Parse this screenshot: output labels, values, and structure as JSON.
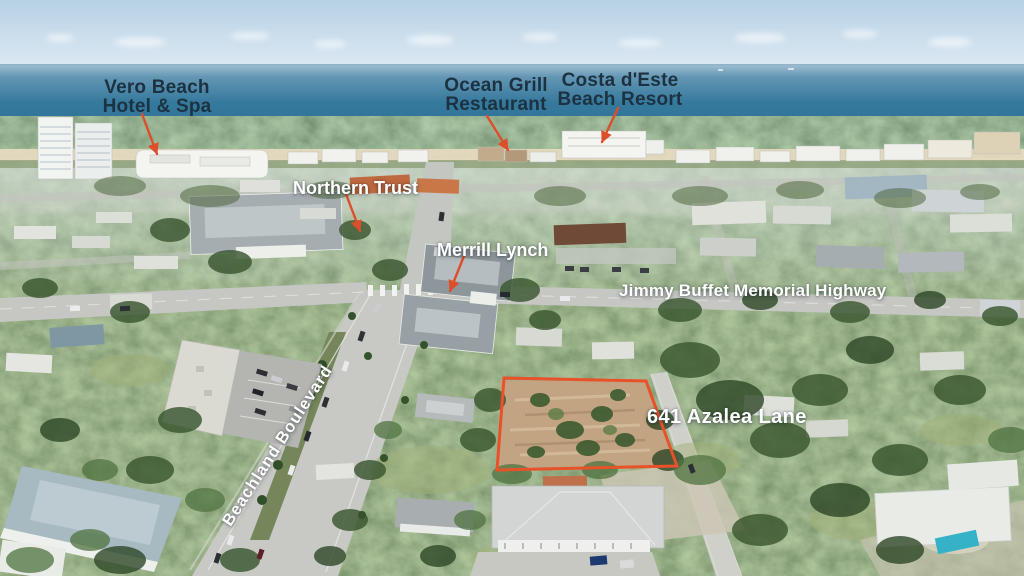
{
  "meta": {
    "type": "aerial-photograph",
    "width": 1024,
    "height": 576
  },
  "theme": {
    "arrow_color": "#dd4e2b",
    "outline_color": "#e8512a",
    "label_dark": "#1c3240",
    "label_light": "#ffffff"
  },
  "scene_palette": {
    "sky": "#bcd4e7",
    "ocean": "#2f7396",
    "sand": "#e5d9bf",
    "foliage": "#5c7049",
    "roads": "#c8c9c4",
    "vacant_lot_dirt": "#c2a482"
  },
  "labels": {
    "hotel": {
      "text": "Vero Beach\nHotel & Spa"
    },
    "ocean_grill": {
      "text": "Ocean Grill\nRestaurant"
    },
    "costa_deste": {
      "text": "Costa d'Este\nBeach Resort"
    },
    "northern_trust": {
      "text": "Northern Trust"
    },
    "merrill_lynch": {
      "text": "Merrill Lynch"
    },
    "highway": {
      "text": "Jimmy Buffet Memorial Highway"
    },
    "beachland_blvd": {
      "text": "Beachland Boulevard"
    },
    "property_address": {
      "text": "641 Azalea Lane"
    }
  },
  "property": {
    "outline_points": "504,378 646,381 677,466 497,470"
  }
}
